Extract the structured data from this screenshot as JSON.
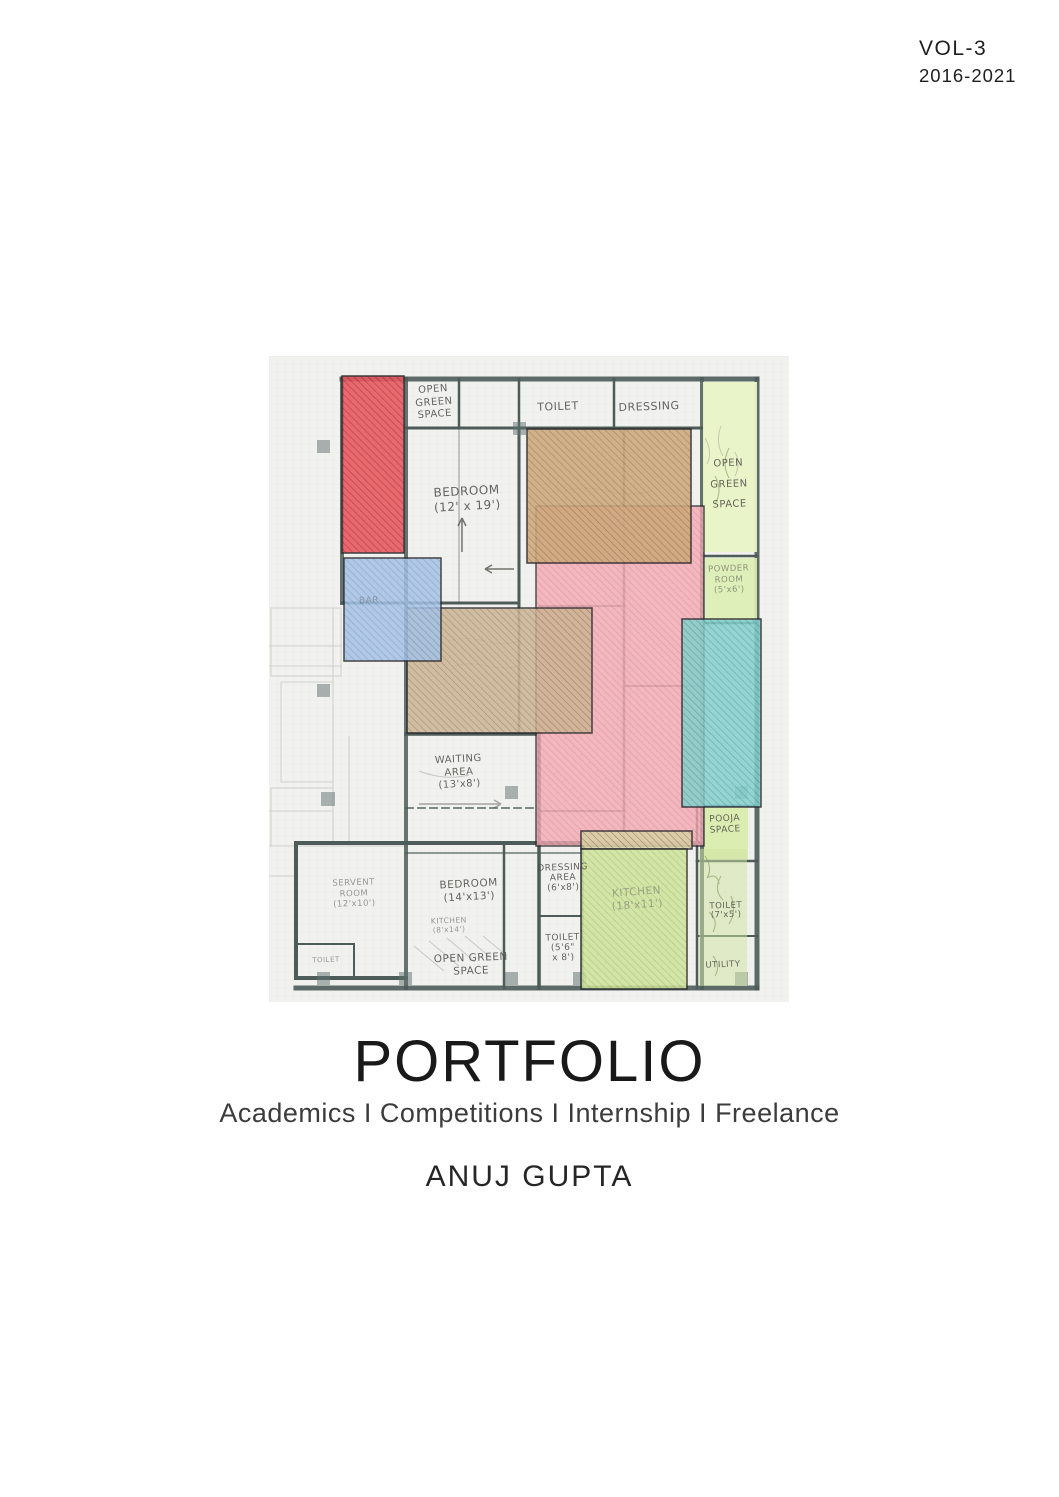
{
  "volume": {
    "line1": "VOL-3",
    "line2": "2016-2021"
  },
  "title_block": {
    "title": "PORTFOLIO",
    "subtitle": "Academics I Competitions I Internship I Freelance",
    "author": "ANUJ GUPTA"
  },
  "floor_plan": {
    "labels": {
      "open_green_top": "OPEN\nGREEN\nSPACE",
      "toilet_top": "TOILET",
      "dressing_top": "DRESSING",
      "bedroom_main": "BEDROOM\n(12' x 19')",
      "open_green_right": "OPEN\nGREEN\nSPACE",
      "powder_room": "POWDER\nROOM\n(5'x6')",
      "bar": "BAR",
      "waiting_area": "WAITING\nAREA\n(13'x8')",
      "pooja_space": "POOJA\nSPACE",
      "servant_room": "SERVENT\nROOM\n(12'x10')",
      "toilet_bottom_left": "TOILET",
      "bedroom_two": "BEDROOM\n(14'x13')",
      "kitchen_small": "KITCHEN\n(8'x14')",
      "open_green_bottom": "OPEN GREEN\nSPACE",
      "dressing_area": "DRESSING\nAREA\n(6'x8')",
      "toilet_mid": "TOILET\n(5'6\"\nx 8')",
      "kitchen_main": "KITCHEN\n(18'x11')",
      "toilet_right": "TOILET\n(7'x5')",
      "utility": "UTILITY"
    },
    "zone_colors": {
      "red": "#e9575e",
      "blue": "#a6c3e6",
      "tan": "#cda97d",
      "pink": "#f3a9b4",
      "teal": "#84d0cd",
      "green": "#cfe49c",
      "khaki": "#d9d1a4",
      "light_green": "#e9f3c6",
      "wall": "#4d5c59"
    }
  }
}
